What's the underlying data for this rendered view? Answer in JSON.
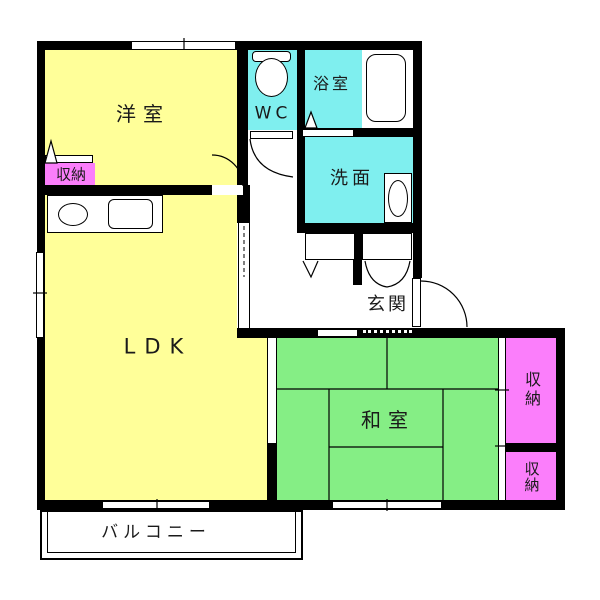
{
  "palette": {
    "bg": "#ffffff",
    "wall": "#000000",
    "room_yellow": "#ffff99",
    "room_cyan": "#7fefef",
    "room_green": "#85ee85",
    "room_pink": "#fb7efb"
  },
  "rooms": {
    "youshitsu": {
      "label": "洋室"
    },
    "ldk": {
      "label": "LDK"
    },
    "washitsu": {
      "label": "和室"
    },
    "wc": {
      "label": "WC"
    },
    "bath": {
      "label": "浴室"
    },
    "wash": {
      "label": "洗面"
    },
    "genkan": {
      "label": "玄関"
    },
    "closet_west": {
      "label": "収納"
    },
    "closet_right_top": {
      "label": "収納"
    },
    "closet_right_bottom": {
      "label": "収納"
    },
    "balcony": {
      "label": "バルコニー"
    }
  },
  "fixtures": [
    "toilet-icon",
    "bathtub-icon",
    "washbasin-icon",
    "kitchen-sink-icon",
    "stove-icon"
  ]
}
